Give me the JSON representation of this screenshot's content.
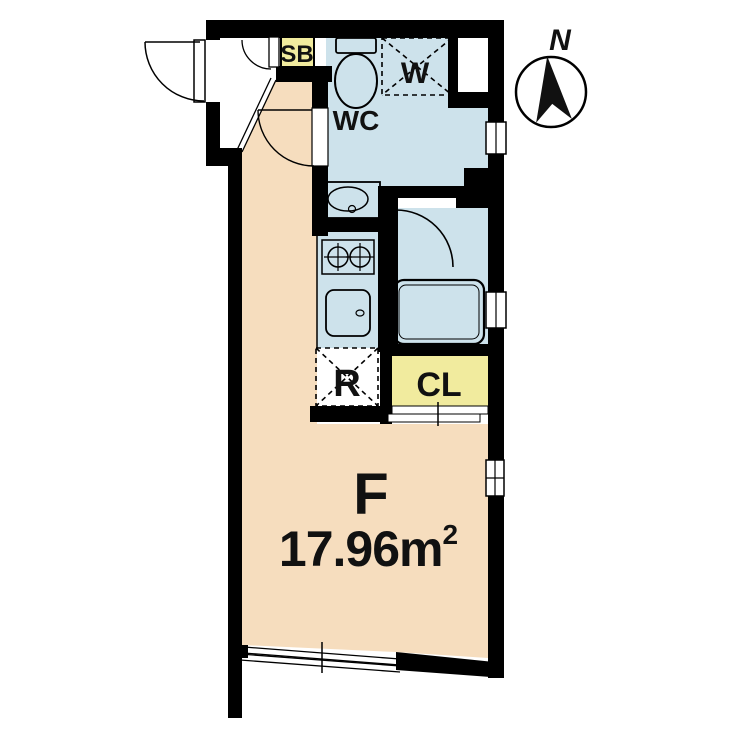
{
  "plan": {
    "room": {
      "name": "F",
      "area_value": "17.96",
      "area_unit": "m",
      "area_sup": "2"
    },
    "labels": {
      "shoe_box": "SB",
      "water_closet": "WC",
      "washer": "W",
      "refrigerator": "R",
      "closet": "CL"
    },
    "compass": {
      "north": "N"
    },
    "colors": {
      "floor": "#f6ddbe",
      "wet": "#cde2eb",
      "storage": "#f1eb9e",
      "wall": "#000000",
      "ink": "#111111"
    }
  }
}
